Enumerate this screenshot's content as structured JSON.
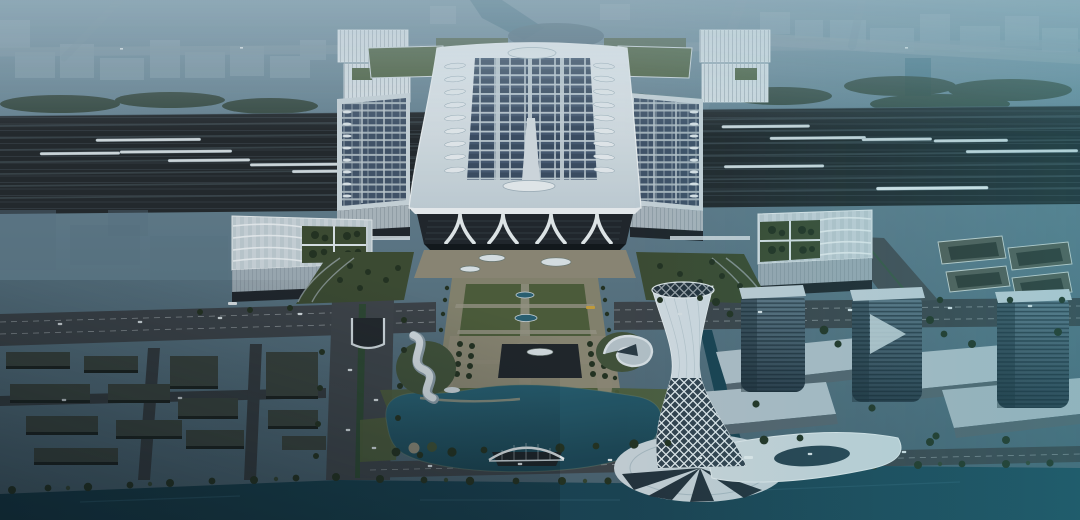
{
  "scene": {
    "type": "architectural-aerial-rendering",
    "time_of_day": "dusk",
    "subject": "High-speed railway station complex with solar-panel roof, landscaped central axis plaza, lakefront twisted landmark tower, glass high-rises and canal",
    "landmarks": [
      "hazy-north-cityscape",
      "elevated-highway",
      "railway-yard",
      "white-bullet-trains",
      "main-station-hall",
      "solar-panel-roof",
      "teardrop-roof-vents",
      "side-platform-halls",
      "green-roof-annexes",
      "entrance-canopy",
      "garden-roof-wing-left",
      "garden-roof-wing-right",
      "central-landscaped-axis",
      "south-sunken-plaza",
      "west-residential-blocks",
      "lake",
      "arched-pedestrian-bridge",
      "wave-pavilion",
      "shell-pavilion",
      "twisted-lattice-tower",
      "tower-plinth-canopy",
      "glass-high-rises",
      "podium-halls",
      "south-canal"
    ]
  },
  "counts": {
    "solar_panel_rows": 13,
    "solar_panel_columns": 8,
    "roof_vents_per_column": 9,
    "trains_visible": 13,
    "glass_towers": 3,
    "axis_water_ovals": 4
  },
  "palette": {
    "sky_top": "#72909f",
    "sky_bottom": "#475f6c",
    "haze": "#b9d0dc",
    "far_building": "#8aa2af",
    "far_road": "#7e95a3",
    "far_green": "#2f4134",
    "river": "#4b7385",
    "rail_bed": "#24292c",
    "rail_stripe": "#343c41",
    "train": "#d6dfe2",
    "roof_bright": "#eef3f6",
    "roof_white": "#d6e0e5",
    "solar_panel": "#3c4e63",
    "solar_panel_light": "#4d617a",
    "solar_gap": "#c3d0d7",
    "green_roof": "#4f6341",
    "lawn": "#4e5e3a",
    "garden": "#3d4c31",
    "tree": "#243220",
    "plaza": "#8f8a76",
    "path_light": "#a3a090",
    "road": "#3e4449",
    "lane": "#ccd3d6",
    "glass_dark": "#20262b",
    "water_lake": "#2a6476",
    "water_lake_deep": "#1b4553",
    "water_canal": "#1a4352",
    "water_canal_deep": "#123744",
    "block_dark": "#2d3531",
    "block_top": "#3a433d",
    "tower_glass_hi": "#647a88",
    "tower_glass_lo": "#2b3945",
    "tower_cap": "#c7d3d9",
    "landmark_white": "#d8e1e6",
    "lattice_glass": "#33434e",
    "tan_stripe": "#b9b7a0",
    "teal_tint": "#2fc3d4"
  }
}
